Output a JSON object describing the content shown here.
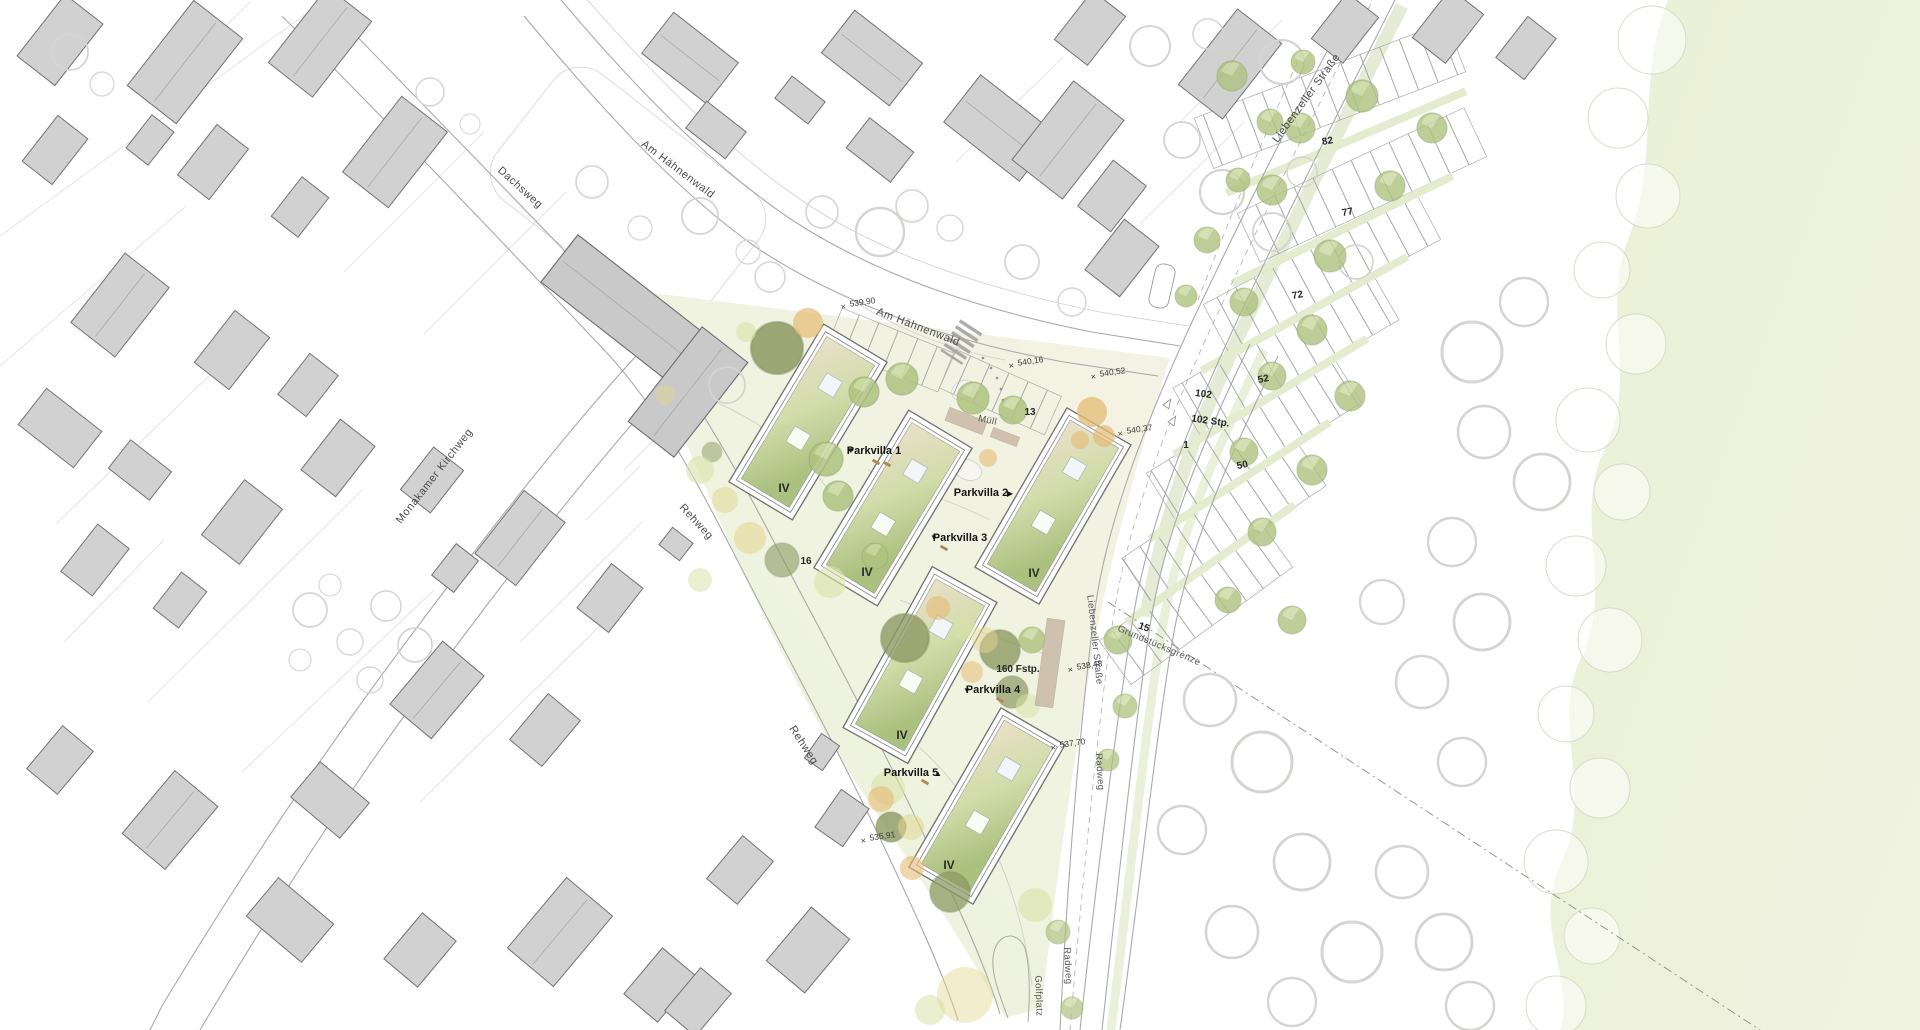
{
  "streets": {
    "dachsweg": "Dachsweg",
    "am_haehnenwald": "Am Hähnenwald",
    "monakamer_kirchweg": "Monakamer Kirchweg",
    "rehweg": "Rehweg",
    "liebenzeller_strasse": "Liebenzeller Straße",
    "radweg": "Radweg",
    "golfplatz": "Golfplatz",
    "grundstuecksgrenze": "Grundstücksgrenze"
  },
  "parkvillas": [
    {
      "label": "Parkvilla 1",
      "stories": "IV"
    },
    {
      "label": "Parkvilla 2",
      "stories": "IV"
    },
    {
      "label": "Parkvilla 3",
      "stories": "IV"
    },
    {
      "label": "Parkvilla 4",
      "stories": "IV"
    },
    {
      "label": "Parkvilla 5",
      "stories": "IV"
    }
  ],
  "site_labels": {
    "muell": "Müll",
    "bike_parking": "160 Fstp.",
    "car_parking_total": "102 Stp."
  },
  "elevation_markers": [
    "539,90",
    "540,16",
    "540,52",
    "540,37",
    "538,48",
    "537,70",
    "535,91"
  ],
  "parking_row_numbers": {
    "row_102": "102",
    "row_82": "82",
    "row_77": "77",
    "row_72": "72",
    "row_52": "52",
    "row_50": "50",
    "row_15": "15",
    "row_13": "13",
    "row_16": "16",
    "row_1": "1"
  },
  "icons": {
    "entrance_marker_down": "▼",
    "entrance_marker_right": "▶",
    "entrance_marker_up": "▲",
    "elevation_cross": "×"
  },
  "colors": {
    "existing_building": "#d1d1d2",
    "new_roof_green": "#aec27f",
    "new_roof_beige": "#e9e0c8",
    "site_green": "#ebf1dc",
    "meadow_green": "#ebf0d9",
    "tree_olive": "#8e9a64",
    "tree_green": "#aec37f",
    "tree_orange": "#e4bb74",
    "road_line": "#a9a9a9"
  }
}
